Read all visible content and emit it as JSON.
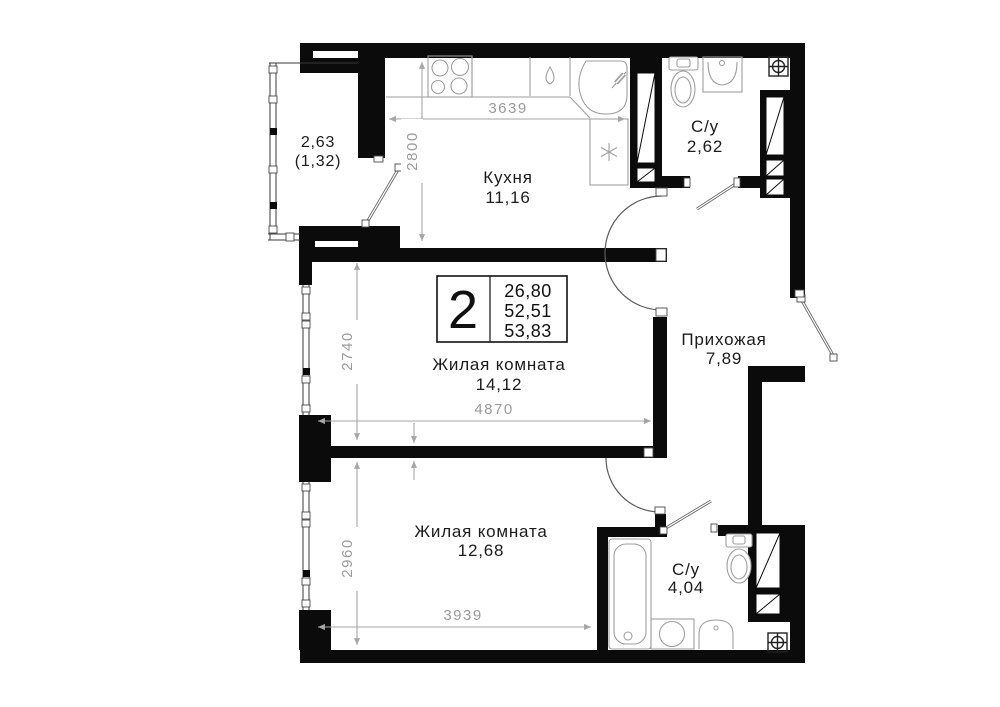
{
  "plan": {
    "badge": {
      "rooms_count": "2",
      "areas": [
        "26,80",
        "52,51",
        "53,83"
      ]
    },
    "rooms": {
      "balcony": {
        "area": "2,63",
        "area_reduced": "(1,32)"
      },
      "kitchen": {
        "name": "Кухня",
        "area": "11,16"
      },
      "bath_top": {
        "name": "С/у",
        "area": "2,62"
      },
      "hallway": {
        "name": "Прихожая",
        "area": "7,89"
      },
      "living1": {
        "name": "Жилая комната",
        "area": "14,12"
      },
      "living2": {
        "name": "Жилая комната",
        "area": "12,68"
      },
      "bath_bottom": {
        "name": "С/у",
        "area": "4,04"
      }
    },
    "dimensions": {
      "kitchen_width": "3639",
      "kitchen_depth": "2800",
      "living1_width": "4870",
      "living1_depth": "2740",
      "living2_width": "3939",
      "living2_depth": "2960"
    },
    "icons": {
      "ventilation": "crosshair-in-square",
      "note": "asterisk",
      "sink_mark": "water-drop"
    },
    "colors": {
      "wall": "#0b0b0b",
      "fixture_line": "#9e9e9e",
      "dimension": "#9a9a9a",
      "label": "#1c1c1c",
      "background": "#ffffff"
    }
  }
}
